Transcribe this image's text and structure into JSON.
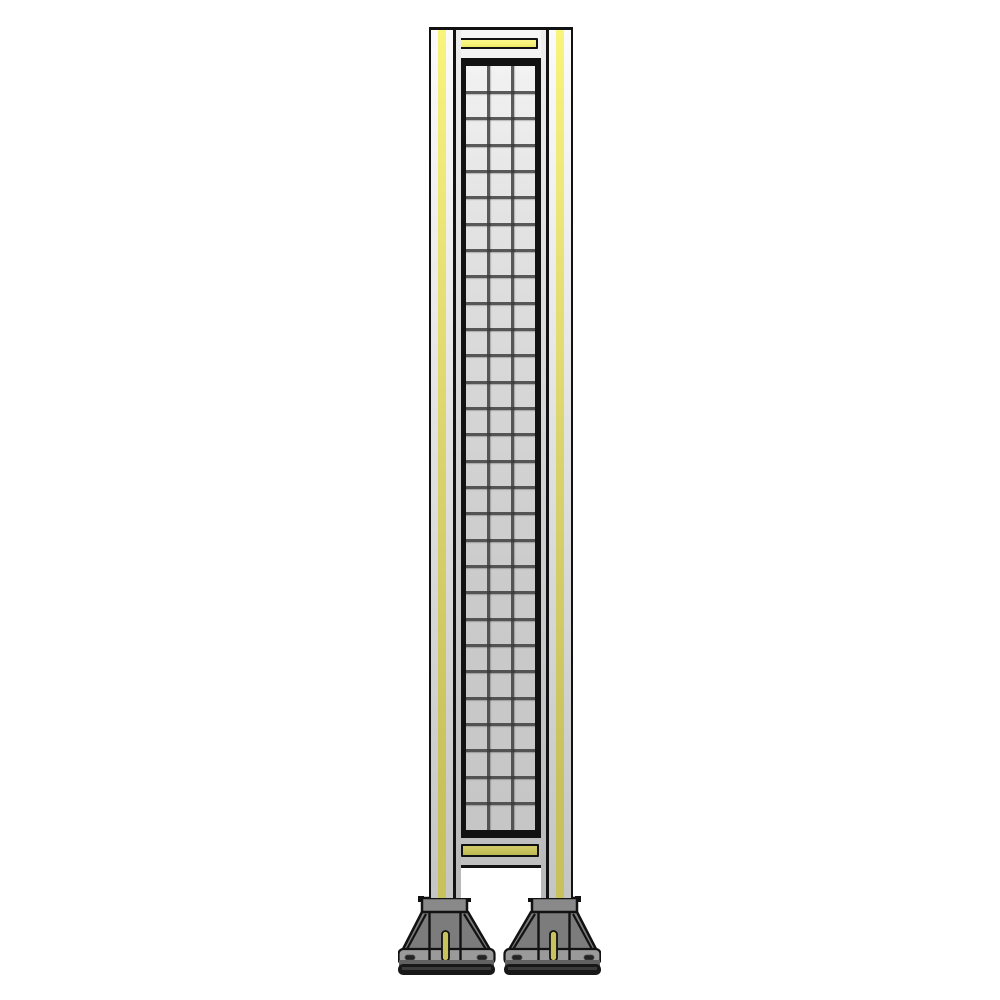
{
  "scene": {
    "object": "tall machine-guard safety fence panel with wire mesh, yellow accent strips and two bolted mounting feet",
    "background": "#ffffff"
  },
  "palette": {
    "outline": "#121212",
    "accent_yellow": "#f8f47c",
    "accent_yellow_dark": "#c8c25c",
    "frame_light": "#ececec",
    "frame_dark": "#bfbfbf",
    "mesh_wire": "#3a3a3a",
    "foot_body": "#7c7c7c",
    "foot_socket": "#898989",
    "foot_base_top": "#9a9a9a",
    "foot_base_front": "#616161"
  },
  "mesh": {
    "columns": 3,
    "rows": 29
  },
  "feet": {
    "count": 2,
    "bolt_slots_visible_per_foot": 2,
    "anchor_slot_color": "#c9c35e"
  }
}
